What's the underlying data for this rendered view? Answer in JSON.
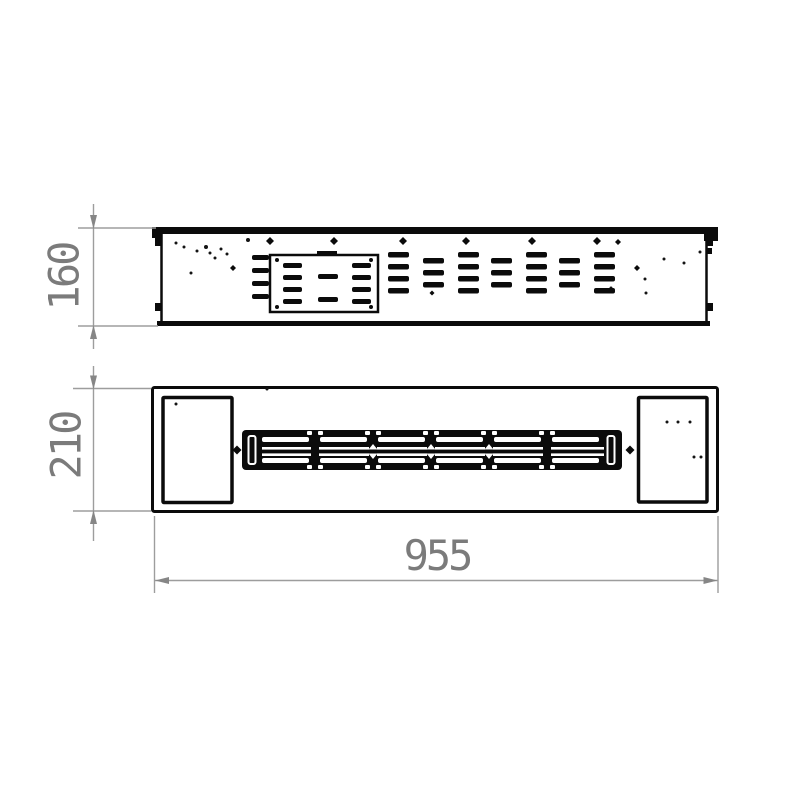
{
  "dimensions": {
    "height": {
      "value": "160"
    },
    "depth": {
      "value": "210"
    },
    "width": {
      "value": "955"
    }
  },
  "colors": {
    "paper": "#ffffff",
    "ink": "#0b0b0b",
    "dim_line": "#9d9d9d",
    "dim_arrow": "#868686",
    "dim_text": "#7b7b7b"
  },
  "drawing": {
    "groups": [
      {
        "target": "side-view-screws",
        "name": "screw-icon",
        "type": "diamonds",
        "fill": "#0b0b0b",
        "items": [
          [
            270,
            241,
            8
          ],
          [
            334,
            241,
            8
          ],
          [
            403,
            241,
            8
          ],
          [
            466,
            241,
            8
          ],
          [
            532,
            241,
            8
          ],
          [
            597,
            241,
            8
          ],
          [
            618,
            242,
            6
          ],
          [
            233,
            268,
            6
          ],
          [
            637,
            268,
            6
          ],
          [
            432,
            293,
            5
          ]
        ]
      },
      {
        "target": "side-view-speckles",
        "name": "speckle-dot",
        "type": "dots",
        "fill": "#141414",
        "items": [
          [
            248,
            240,
            2
          ],
          [
            176,
            243,
            1.5
          ],
          [
            184,
            247,
            1.5
          ],
          [
            197,
            251,
            1.5
          ],
          [
            206,
            247,
            2
          ],
          [
            210,
            253,
            1.5
          ],
          [
            215,
            258,
            1.5
          ],
          [
            221,
            249,
            1.5
          ],
          [
            227,
            254,
            1.5
          ],
          [
            191,
            273,
            1.5
          ],
          [
            302,
            264,
            2
          ],
          [
            646,
            293,
            1.5
          ],
          [
            611,
            288,
            1.5
          ],
          [
            664,
            259,
            1.5
          ],
          [
            700,
            252,
            1.5
          ],
          [
            684,
            263,
            1.5
          ],
          [
            645,
            279,
            1.5
          ]
        ]
      },
      {
        "target": "top-view-speckles",
        "name": "speckle-dot",
        "type": "dots",
        "fill": "#141414",
        "items": [
          [
            267,
            389,
            1.5
          ],
          [
            176,
            404,
            1.5
          ],
          [
            667,
            422,
            1.5
          ],
          [
            678,
            422,
            1.5
          ],
          [
            690,
            422,
            1.5
          ],
          [
            694,
            457,
            1.5
          ],
          [
            701,
            457,
            1.5
          ]
        ]
      },
      {
        "target": "control-panel-screws",
        "name": "panel-screw-icon",
        "type": "dots",
        "fill": "#0b0b0b",
        "items": [
          [
            277,
            260,
            2
          ],
          [
            371,
            260,
            2
          ],
          [
            277,
            307,
            2
          ],
          [
            371,
            307,
            2
          ]
        ]
      },
      {
        "target": "panel-vents",
        "name": "panel-vent-slot",
        "type": "grid",
        "fill": "#0b0b0b",
        "w": 19,
        "h": 5,
        "rx": 2,
        "cols": [
          283,
          352
        ],
        "rows": [
          263,
          275,
          287,
          299
        ]
      },
      {
        "target": "panel-vents",
        "name": "panel-vent-slot",
        "type": "grid",
        "fill": "#0b0b0b",
        "w": 20,
        "h": 5,
        "rx": 2,
        "cols": [
          318
        ],
        "rows": [
          274,
          297
        ]
      },
      {
        "target": "vent-field",
        "name": "vent-slot",
        "type": "grid",
        "fill": "#0b0b0b",
        "w": 17,
        "h": 5,
        "rx": 2,
        "cols": [
          252
        ],
        "rows": [
          255,
          268,
          281,
          294
        ]
      },
      {
        "target": "vent-field",
        "name": "vent-slot",
        "type": "grid",
        "fill": "#0b0b0b",
        "w": 21,
        "h": 5.5,
        "rx": 2,
        "cols": [
          388,
          458,
          526,
          594
        ],
        "rows": [
          252,
          264,
          276,
          288
        ]
      },
      {
        "target": "vent-field",
        "name": "vent-slot",
        "type": "grid",
        "fill": "#0b0b0b",
        "w": 21,
        "h": 5.5,
        "rx": 2,
        "cols": [
          423,
          491,
          559
        ],
        "rows": [
          258,
          270,
          282
        ]
      },
      {
        "target": "burner-slots",
        "name": "burner-slot",
        "type": "grid",
        "fill": "#ffffff",
        "w": 47,
        "h": 5,
        "rx": 2,
        "cols": [
          262,
          320,
          378,
          436,
          494,
          552
        ],
        "rows": [
          437,
          458
        ]
      },
      {
        "target": "burner-notches",
        "name": "burner-notch",
        "type": "grid",
        "fill": "#ffffff",
        "w": 5,
        "h": 4,
        "rx": 1,
        "cols": [
          307,
          318,
          365,
          376,
          423,
          434,
          481,
          492,
          539,
          550
        ],
        "rows": [
          431,
          465
        ]
      },
      {
        "target": "burner-joints",
        "name": "burner-joint-bar",
        "type": "grid",
        "fill": "#0b0b0b",
        "w": 8,
        "h": 14,
        "rx": 0,
        "cols": [
          311,
          369,
          427,
          485,
          543
        ],
        "rows": [
          445
        ]
      },
      {
        "target": "burner-joints",
        "name": "burner-joint-arrow",
        "type": "tris",
        "fill": "#ffffff",
        "items": [
          "368.5,449.5 377.5,449.5 373,444",
          "368.5,453.5 377.5,453.5 373,459",
          "426.5,449.5 435.5,449.5 431,444",
          "426.5,453.5 435.5,453.5 431,459",
          "484.5,449.5 493.5,449.5 489,444",
          "484.5,453.5 493.5,453.5 489,459"
        ]
      },
      {
        "target": "burner-diamonds",
        "name": "burner-screw-icon",
        "type": "diamonds",
        "fill": "#0b0b0b",
        "items": [
          [
            237,
            450,
            9
          ],
          [
            630,
            450,
            9
          ]
        ]
      }
    ]
  }
}
